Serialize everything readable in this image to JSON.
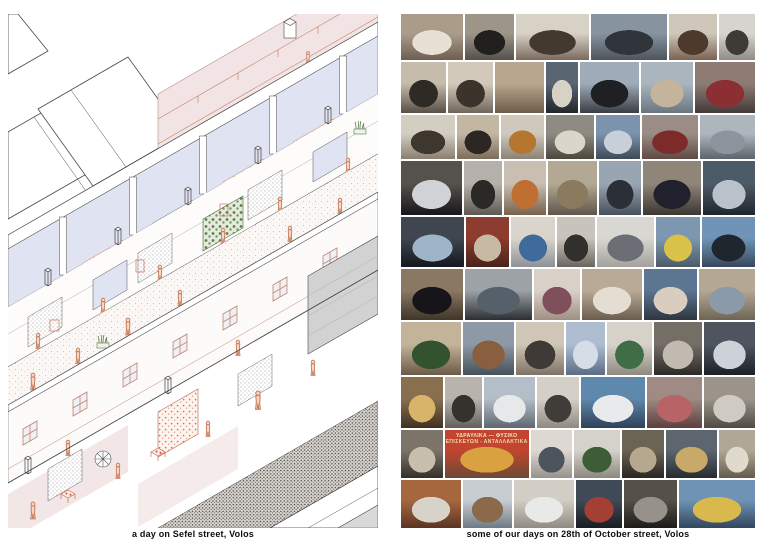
{
  "page": {
    "background": "#ffffff"
  },
  "left_panel": {
    "caption": "a day on Sefel street, Volos",
    "palette": {
      "line": "#3f3f3f",
      "coral": "#c4765a",
      "wall_blue": "#e0e4f2",
      "floor_pink": "#f3e6e7",
      "terrace_pink": "#f2e4e4",
      "plant_green": "#567c44",
      "roof_gray": "#d2d2d2"
    }
  },
  "right_panel": {
    "caption": "some of our days on 28th of October street, Volos",
    "sign_lines": [
      "ΥΔΡΑΥΛΙΚΑ — ΦΥΣΙΚΟ",
      "ΕΠΙΣΚΕΥΩΝ - ΑΝΤΑΛΛΑΚΤΙΚΑ"
    ],
    "accent_blue": "#5b87b5",
    "collage": {
      "rows": [
        {
          "h": 50,
          "tiles": [
            {
              "f": 70,
              "c1": "#ab9c8a",
              "c2": "#6d5f50",
              "fig": "#e8e1d3"
            },
            {
              "f": 55,
              "c1": "#9d9588",
              "c2": "#55504a",
              "fig": "#21201e"
            },
            {
              "f": 82,
              "c1": "#d8d1c6",
              "c2": "#7b6a5d",
              "fig": "#44392f"
            },
            {
              "f": 85,
              "c1": "#87939f",
              "c2": "#4e545b",
              "fig": "#30353b"
            },
            {
              "f": 55,
              "c1": "#cfc7ba",
              "c2": "#7a6352",
              "fig": "#4c3a2c"
            },
            {
              "f": 40,
              "c1": "#d7d4cf",
              "c2": "#8f8c85",
              "fig": "#3c3b37"
            }
          ]
        },
        {
          "h": 55,
          "tiles": [
            {
              "f": 48,
              "c1": "#c6bcab",
              "c2": "#585044",
              "fig": "#2e2a24"
            },
            {
              "f": 48,
              "c1": "#d2c9ba",
              "c2": "#6f655a",
              "fig": "#3b332c"
            },
            {
              "f": 52,
              "c1": "#b8a78f",
              "c2": "#6e5c49"
            },
            {
              "f": 34,
              "c1": "#5a6572",
              "c2": "#23262b",
              "fig": "#d8d2c6"
            },
            {
              "f": 62,
              "c1": "#9fabb8",
              "c2": "#3a3e44",
              "fig": "#1e2024"
            },
            {
              "f": 55,
              "c1": "#aab5be",
              "c2": "#697680",
              "fig": "#c3b49b"
            },
            {
              "f": 64,
              "c1": "#8d7b74",
              "c2": "#443a39",
              "fig": "#8c2f33"
            }
          ]
        },
        {
          "h": 48,
          "tiles": [
            {
              "f": 56,
              "c1": "#d3cdc2",
              "c2": "#8a7f71",
              "fig": "#3e3730"
            },
            {
              "f": 44,
              "c1": "#c3b6a2",
              "c2": "#7c6d5a",
              "fig": "#2c2723"
            },
            {
              "f": 46,
              "c1": "#cfc9bd",
              "c2": "#8b8274",
              "fig": "#b7762f"
            },
            {
              "f": 50,
              "c1": "#8e8b82",
              "c2": "#4b463e",
              "fig": "#dad6cb"
            },
            {
              "f": 46,
              "c1": "#7b93ad",
              "c2": "#3e4a56",
              "fig": "#c7d0d8"
            },
            {
              "f": 58,
              "c1": "#9b8d85",
              "c2": "#5f4a44",
              "fig": "#7c2a2a"
            },
            {
              "f": 58,
              "c1": "#aeb6bd",
              "c2": "#5d646b",
              "fig": "#8c959d"
            }
          ]
        },
        {
          "h": 58,
          "tiles": [
            {
              "f": 66,
              "c1": "#55514b",
              "c2": "#17161a",
              "fig": "#cfd3d6"
            },
            {
              "f": 40,
              "c1": "#b5b1aa",
              "c2": "#5d5952",
              "fig": "#2b2927"
            },
            {
              "f": 46,
              "c1": "#c8beb2",
              "c2": "#77614d",
              "fig": "#c06f33"
            },
            {
              "f": 52,
              "c1": "#b3a894",
              "c2": "#5f564a",
              "fig": "#8a7a5e"
            },
            {
              "f": 46,
              "c1": "#9aa5b2",
              "c2": "#47505c",
              "fig": "#2b2f38"
            },
            {
              "f": 62,
              "c1": "#8f8579",
              "c2": "#3c3732",
              "fig": "#20212c"
            },
            {
              "f": 56,
              "c1": "#4d5a68",
              "c2": "#20262e",
              "fig": "#b9c2cb"
            }
          ]
        },
        {
          "h": 55,
          "tiles": [
            {
              "f": 66,
              "c1": "#3f4650",
              "c2": "#15181d",
              "fig": "#9fb4c7"
            },
            {
              "f": 46,
              "c1": "#8e3b30",
              "c2": "#48231d",
              "fig": "#c8b9a2"
            },
            {
              "f": 46,
              "c1": "#d9d5cd",
              "c2": "#8d9197",
              "fig": "#3f6a99"
            },
            {
              "f": 40,
              "c1": "#c9c4bb",
              "c2": "#6a665f",
              "fig": "#32302c"
            },
            {
              "f": 60,
              "c1": "#d9d7d2",
              "c2": "#a3a19c",
              "fig": "#6b6f75"
            },
            {
              "f": 46,
              "c1": "#7e97b0",
              "c2": "#4c5a68",
              "fig": "#d8c24a"
            },
            {
              "f": 56,
              "c1": "#6f94b8",
              "c2": "#38475a",
              "fig": "#20262e"
            }
          ]
        },
        {
          "h": 55,
          "tiles": [
            {
              "f": 62,
              "c1": "#8a7863",
              "c2": "#3f352a",
              "fig": "#17151a"
            },
            {
              "f": 66,
              "c1": "#9da2a6",
              "c2": "#2c2e33",
              "fig": "#55606b"
            },
            {
              "f": 46,
              "c1": "#d9d0c8",
              "c2": "#a08f85",
              "fig": "#7f4f5c"
            },
            {
              "f": 60,
              "c1": "#b8aa96",
              "c2": "#6a5d4e",
              "fig": "#e3ddd2"
            },
            {
              "f": 52,
              "c1": "#5c7590",
              "c2": "#2d3540",
              "fig": "#d8cdbf"
            },
            {
              "f": 56,
              "c1": "#b4a794",
              "c2": "#6f6554",
              "fig": "#8a9aa8"
            }
          ]
        },
        {
          "h": 58,
          "tiles": [
            {
              "f": 62,
              "c1": "#c4b39b",
              "c2": "#6b5a45",
              "fig": "#33522e"
            },
            {
              "f": 52,
              "c1": "#8d99a6",
              "c2": "#46505a",
              "fig": "#8a5f3f"
            },
            {
              "f": 50,
              "c1": "#cfc6b8",
              "c2": "#7e7264",
              "fig": "#3f3a35"
            },
            {
              "f": 40,
              "c1": "#aebdd0",
              "c2": "#5a6d86",
              "fig": "#d6dde6"
            },
            {
              "f": 46,
              "c1": "#d6d2ca",
              "c2": "#8f8a81",
              "fig": "#3f6e46"
            },
            {
              "f": 50,
              "c1": "#746e66",
              "c2": "#2b2a28",
              "fig": "#c0bab0"
            },
            {
              "f": 52,
              "c1": "#4e555e",
              "c2": "#1d2126",
              "fig": "#cdd2d8"
            }
          ]
        },
        {
          "h": 55,
          "tiles": [
            {
              "f": 46,
              "c1": "#8a6f4f",
              "c2": "#3f311f",
              "fig": "#d8b36a"
            },
            {
              "f": 40,
              "c1": "#b8b4ad",
              "c2": "#63605a",
              "fig": "#34322f"
            },
            {
              "f": 56,
              "c1": "#b4bec8",
              "c2": "#5f6871",
              "fig": "#e6e8ea"
            },
            {
              "f": 46,
              "c1": "#d4d0c8",
              "c2": "#8e8a82",
              "fig": "#403c37"
            },
            {
              "f": 70,
              "c1": "#5f88ad",
              "c2": "#2f4156",
              "fig": "#e8eaec"
            },
            {
              "f": 60,
              "c1": "#a08a84",
              "c2": "#5c3f3e",
              "fig": "#b86467"
            },
            {
              "f": 56,
              "c1": "#9a948a",
              "c2": "#4f4b44",
              "fig": "#d0cbc2"
            }
          ]
        },
        {
          "h": 52,
          "tiles": [
            {
              "f": 46,
              "c1": "#7c7468",
              "c2": "#352f29",
              "fig": "#c8beae"
            },
            {
              "f": 92,
              "c1": "#c2452f",
              "c2": "#6b4a36",
              "fig": "#d9a13f",
              "sign": true
            },
            {
              "f": 46,
              "c1": "#ddd9d2",
              "c2": "#96928b",
              "fig": "#4c555e"
            },
            {
              "f": 50,
              "c1": "#d5d2cb",
              "c2": "#8b887f",
              "fig": "#3e5c35"
            },
            {
              "f": 46,
              "c1": "#6b6354",
              "c2": "#2a2621",
              "fig": "#b5a88f"
            },
            {
              "f": 56,
              "c1": "#5d666f",
              "c2": "#262b31",
              "fig": "#c9a96a"
            },
            {
              "f": 40,
              "c1": "#b1a795",
              "c2": "#635b4d",
              "fig": "#e0dacd"
            }
          ]
        },
        {
          "h": 52,
          "tiles": [
            {
              "f": 60,
              "c1": "#a6673f",
              "c2": "#5b3424",
              "fig": "#d8d3c9"
            },
            {
              "f": 50,
              "c1": "#c8cdd2",
              "c2": "#6f7984",
              "fig": "#8a6a4a"
            },
            {
              "f": 60,
              "c1": "#d2cec6",
              "c2": "#8f8b83",
              "fig": "#e9e9e7"
            },
            {
              "f": 46,
              "c1": "#3f4a56",
              "c2": "#191d23",
              "fig": "#a33f34"
            },
            {
              "f": 54,
              "c1": "#555149",
              "c2": "#1d1b18",
              "fig": "#96918a"
            },
            {
              "f": 76,
              "c1": "#6e93b4",
              "c2": "#33465c",
              "fig": "#d9b94e"
            }
          ]
        }
      ]
    }
  }
}
